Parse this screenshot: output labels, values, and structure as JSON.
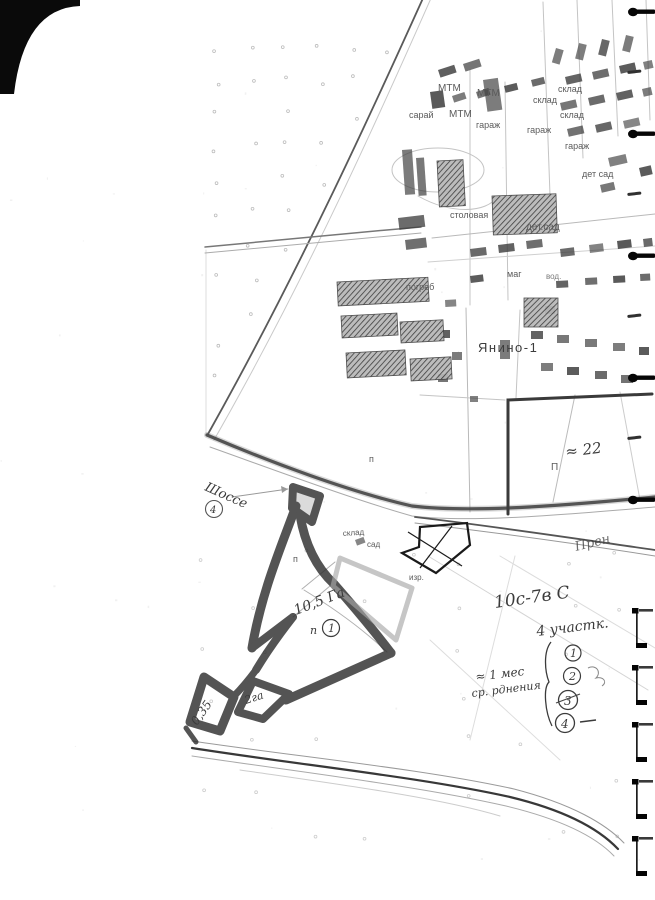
{
  "labels": {
    "mtm1": "МТМ",
    "mtm2": "МТМ",
    "mtm3": "МТМ",
    "saray": "сарай",
    "sklad1": "склад",
    "sklad2": "склад",
    "sklad3": "склад",
    "sklad4": "склад",
    "garazh1": "гараж",
    "garazh2": "гараж",
    "garazh3": "гараж",
    "detsad1": "дет сад",
    "detsad2": "дет.сад",
    "stolovaya": "столовая",
    "mag": "маг",
    "vod": "вод.",
    "pogreb": "погреб",
    "settlement": "Янино-1",
    "sad": "сад",
    "izr": "изр.",
    "p1": "п",
    "p2": "п",
    "p3": "П"
  },
  "handwriting": {
    "shosse": "Шоссе",
    "shosse_circle": "4",
    "approx22": "≈ 22",
    "pren": "Прен",
    "note1": "10с-7в С",
    "note2": "4 участк.",
    "note3": "≈ 1 мес",
    "note4": "ср. рднения",
    "area": "10,5 Га",
    "area_p": "п",
    "area_num": "1",
    "tri_left": "0,35",
    "tri_right": "2га",
    "circled": [
      "1",
      "2",
      "3",
      "4"
    ]
  },
  "colors": {
    "ink": "#1a1a1a",
    "marker": "#2f2f2f",
    "print_gray": "#5a5a5a",
    "binding_black": "#060606"
  }
}
